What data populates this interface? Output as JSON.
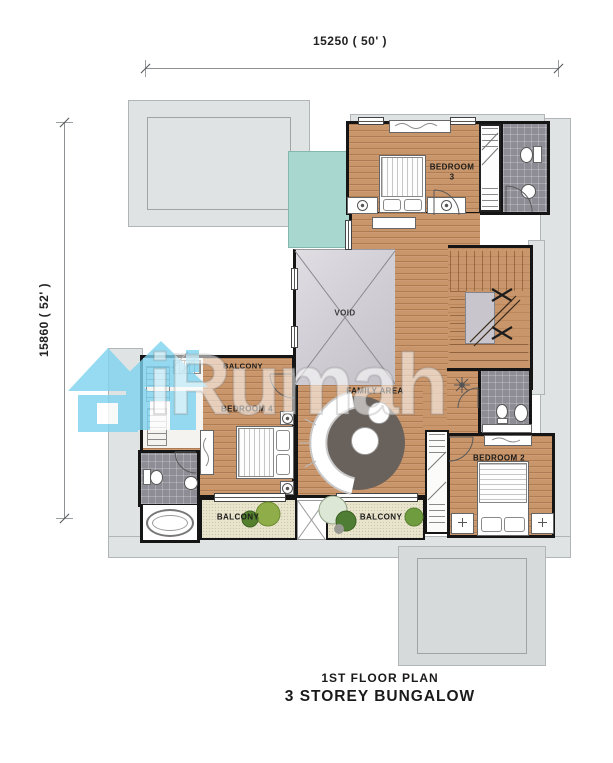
{
  "colors": {
    "wood": "#c9956a",
    "tile": "#8e8d96",
    "balcony": "#e9e4cc",
    "teal": "#a8d7cf",
    "eave": "#e0e3e4",
    "wall": "#151515",
    "rug": "#69615b",
    "watermark-blue": "#7ed3f0",
    "text": "#1b1b1b"
  },
  "dimensions": {
    "top": "15250 ( 50' )",
    "left": "15860 ( 52' )"
  },
  "rooms": {
    "bedroom3_line1": "BEDROOM",
    "bedroom3_line2": "3",
    "void": "VOID",
    "family_area": "FAMILY  AREA",
    "balcony_upper": "BALCONY",
    "bedroom4": "BEDROOM  4",
    "balcony_lower_left": "BALCONY",
    "balcony_lower_middle": "BALCONY",
    "bedroom2": "BEDROOM  2"
  },
  "title": {
    "line1": "1ST  FLOOR  PLAN",
    "line2": "3  STOREY  BUNGALOW"
  },
  "watermark": {
    "brand": "iRumah",
    "logo": "house-icon"
  }
}
